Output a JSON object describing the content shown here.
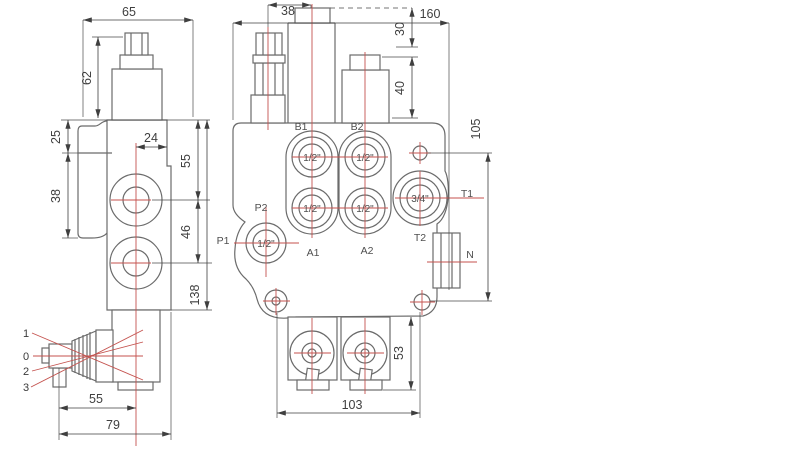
{
  "drawing": {
    "background": "#ffffff",
    "line_color": "#6b6b6b",
    "centerline_color": "#c4524e",
    "dimension_color": "#3f3f3f",
    "left_view": {
      "dims": {
        "overall_depth": "65",
        "cap_height": "62",
        "flange_top_offset": "25",
        "flange_height": "38",
        "port_to_edge": "24",
        "top_to_port1": "55",
        "port_spacing": "46",
        "body_height": "138",
        "lever_to_axis": "55",
        "lever_overall": "79"
      },
      "lever_positions": {
        "pos1": "1",
        "pos0": "0",
        "pos2": "2",
        "pos3": "3"
      }
    },
    "front_view": {
      "dims": {
        "relief_to_spool": "38",
        "overall_width": "160",
        "top_plug_depth": "30",
        "cap_height": "40",
        "mount_hole_spacing_v": "105",
        "lever_section_height": "53",
        "mount_hole_spacing_h": "103"
      },
      "ports": {
        "b1": {
          "label": "B1",
          "size": "1/2\""
        },
        "b2": {
          "label": "B2",
          "size": "1/2\""
        },
        "a1": {
          "label": "A1",
          "size": "1/2\""
        },
        "a2": {
          "label": "A2",
          "size": "1/2\""
        },
        "p1": {
          "label": "P1",
          "size": "1/2\""
        },
        "p2": {
          "label": "P2"
        },
        "t1": {
          "label": "T1",
          "size": "3/4\""
        },
        "t2": {
          "label": "T2"
        },
        "n": {
          "label": "N"
        }
      }
    }
  }
}
